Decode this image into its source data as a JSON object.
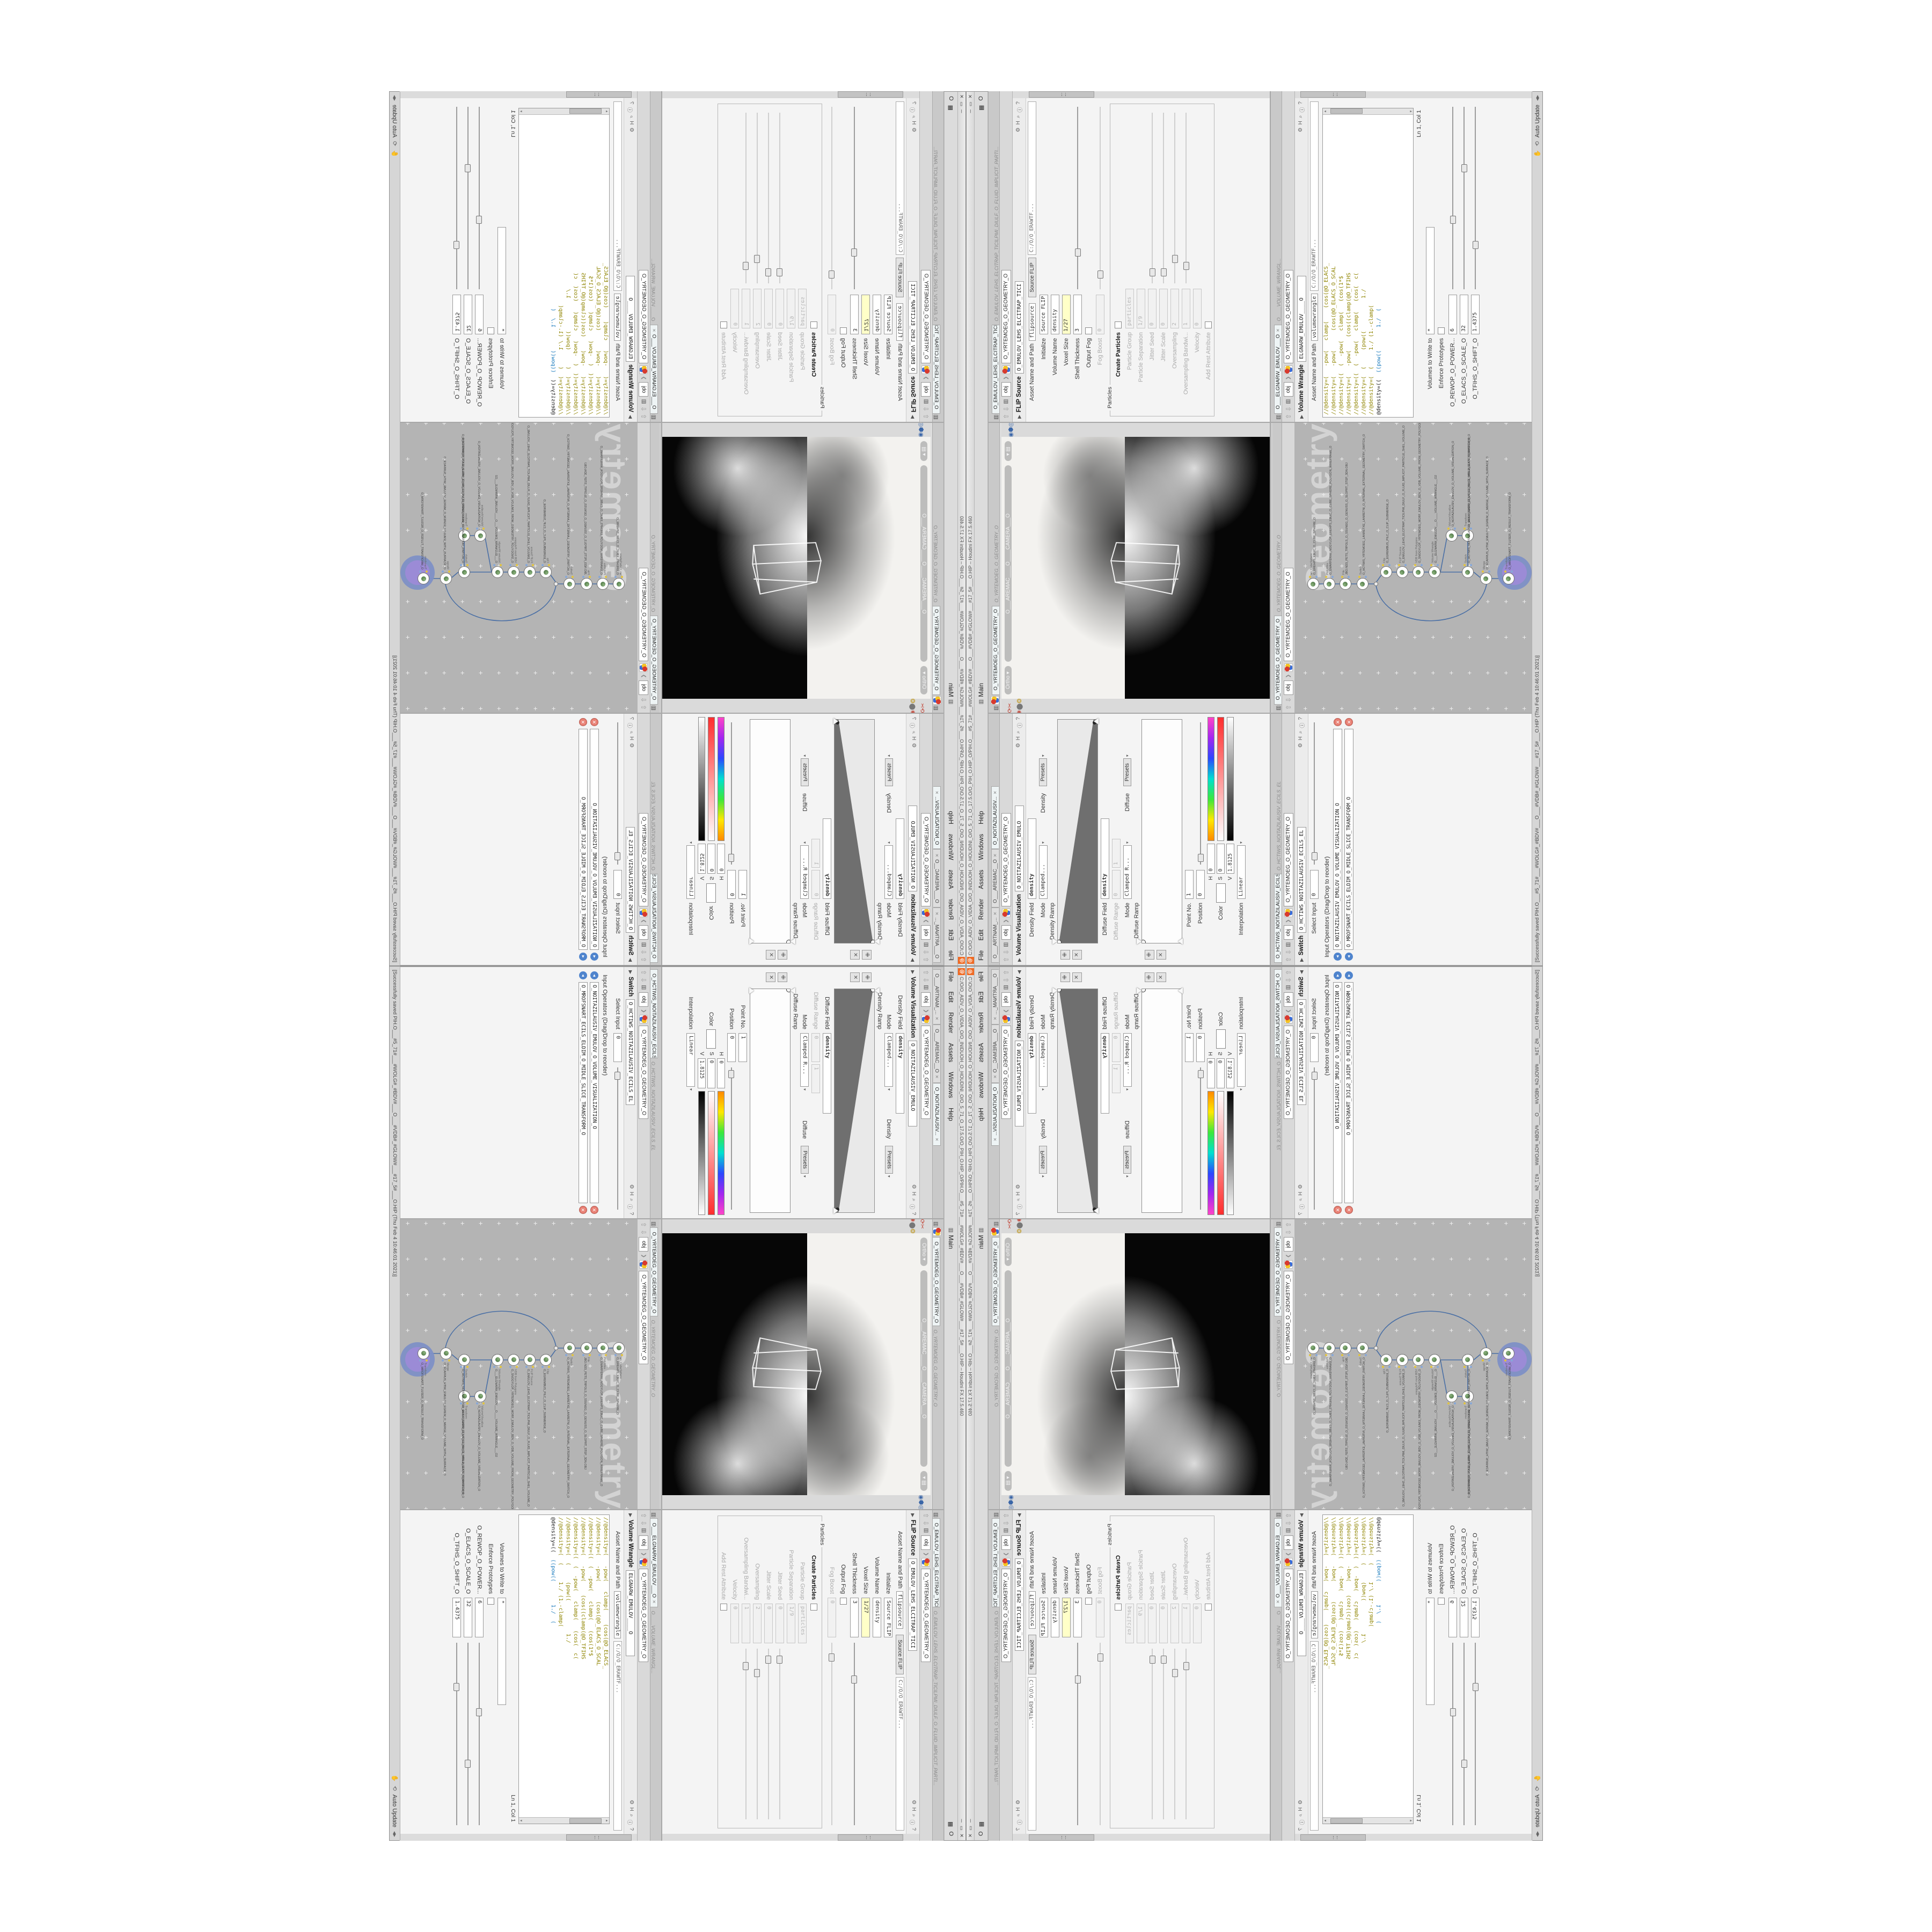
{
  "window": {
    "logo_glyph": "@",
    "title": "C:/O/O_AIDV_O_VIDIA_O/O_INIDUOH_O_HOUDINI_O/O_5_71_O_17.5.O/O_PIH_O.HIP_O/PIH.O___#5_71#___#WOLG#_#BDV#___O___#VDB#_#GLOW#___#17_5#___O.HIP – Houdini FX 17.5.460",
    "btn_min": "─",
    "btn_max": "▭",
    "btn_close": "✕"
  },
  "menu": {
    "items": [
      "File",
      "Edit",
      "Render",
      "Assets",
      "Windows",
      "Help"
    ],
    "desktop_icon": "▥",
    "desktop": "Main",
    "right_grid_icon": "▦",
    "right_o": "O"
  },
  "status": {
    "saved": "[Successfully saved PIH.O___#5_71#___#WOLG#_#BDV#___O___#VDB#_#GLOW#___#17_5#___O.HIP  (Thu Feb  4 10:46:01 2021)]",
    "refresh_icon": "⟲",
    "hand_icon": "✋",
    "auto_update": "Auto Update",
    "dd": "◂▸"
  },
  "crumb": {
    "up": "⇧",
    "down": "⇩",
    "clap": "▥",
    "obj": "obj",
    "sep": "❯",
    "net": "O_YRTEMOEG_O_GEOMETRY_O"
  },
  "flip": {
    "tab": "O_EMULOV_LEHS_ELCITRAP_TICI",
    "title": "O_EMULOV_LEHS_ELCITRAP_TICILPMI_DIULF_O_FLUID_IMPLICIT_PARTI...",
    "type": "FLIP Source",
    "name": "O_EMULOV_LEHS_ELCITRAP_TICI",
    "icons": [
      "⚙",
      "H",
      "⌕",
      "ⓘ",
      "?"
    ],
    "asset_label": "Asset Name and Path",
    "asset": "flipsource",
    "asset_btn": "Source FLIP",
    "path": "C:/O/O_ERAWTF...",
    "params": [
      {
        "l": "Initialize",
        "v": "Source FLIP",
        "cls": "prow"
      },
      {
        "l": "Volume Name",
        "v": "density",
        "cls": "prow"
      },
      {
        "l": "Voxel Size",
        "v": "1/27",
        "cls": "prow hlf"
      },
      {
        "l": "Shell Thickness",
        "v": "3",
        "cls": "prow srow",
        "hs": "left:18%"
      },
      {
        "l": "Output Fog",
        "v": "",
        "cls": "prow cbrow"
      },
      {
        "l": "Fog Boost",
        "v": "0",
        "cls": "prow dis srow",
        "hs": "left:6%"
      }
    ],
    "group": "Particles",
    "pparams": [
      {
        "l": "Create Particles",
        "v": "",
        "cls": "prow cbrow bold"
      },
      {
        "l": "Particle Group",
        "v": "particles",
        "cls": "prow dis"
      },
      {
        "l": "Particle Separation",
        "v": "1/9",
        "cls": "prow dis"
      },
      {
        "l": "Jitter Seed",
        "v": "0",
        "cls": "prow dis srow",
        "hs": "left:4%"
      },
      {
        "l": "Jitter Scale",
        "v": "0",
        "cls": "prow dis srow",
        "hs": "left:4%"
      },
      {
        "l": "Oversampling",
        "v": "2",
        "cls": "prow dis srow",
        "hs": "left:12%"
      },
      {
        "l": "Oversampling Bandwi...",
        "v": "1",
        "cls": "prow dis srow",
        "hs": "left:8%"
      },
      {
        "l": "Velocity",
        "v": "0",
        "cls": "prow dis"
      },
      {
        "l": "Add Rest Attribute",
        "v": "",
        "cls": "prow dis cbrow"
      }
    ]
  },
  "wrangle": {
    "tab": "O___ELGNARW_EMULOV___O",
    "title": "O____VOLUME_WRANGL...",
    "type": "Volume Wrangle",
    "name": "ELGNARW_EMULOV____O",
    "icons": [
      "⚙",
      "H",
      "⌕",
      "ⓘ",
      "?"
    ],
    "asset_label": "Asset Name and Path",
    "asset": "volumewrangle",
    "path": "C:/O/O_ERAWTF...",
    "code": [
      {
        "t": "//@density=(   -pow(   clamp(    (cos(@O_ELACS_"
      },
      {
        "t": "//@density=(   -pow(      (cos(@O_ELACS_O_SCAL"
      },
      {
        "t": "//@density=((  (  -pow(   clamp(   (cos(1*$"
      },
      {
        "t": "//@density=(   -pow(    (cos((clamp(@O_TFIHS"
      },
      {
        "t": "//@density=((  (  -pow(   clamp(   (cos(  c("
      },
      {
        "t": "//@density=(  (     (pow((          1./"
      },
      {
        "t": "//@density=(  (     1./ (1.-clamp("
      }
    ],
    "code_active": "@density=((  ",
    "code_active_blue": "((pow((       1./  (",
    "up_tri": "▴",
    "dn_tri": "▾",
    "lncol": "Ln 1, Col 1",
    "vol_label": "Volumes to Write to",
    "vol": "*",
    "enforce": "Enforce Prototypes",
    "sliders": [
      {
        "l": "O_REWOP_O_POWER...",
        "v": "6",
        "hs": "left:36%"
      },
      {
        "l": "O_ELACS_O_SCALE_O",
        "v": "32",
        "hs": "left:64%"
      },
      {
        "l": "O_TFIHS_O_SHIFT_O",
        "v": "1.4375",
        "hs": "left:22%"
      }
    ]
  },
  "viewport": {
    "tab": "O_YRTEMOEG_O_GEOMETRY_O",
    "top_icons": [
      {
        "g": "◂",
        "n": "back-arrow-icon",
        "c": "vicon"
      },
      {
        "g": "⌕",
        "n": "select-tool-icon",
        "c": "vicon"
      },
      {
        "g": "✎",
        "n": "edit-tool-icon",
        "c": "vicon"
      },
      {
        "g": "✣",
        "n": "handles-tool-icon",
        "c": "vicon"
      },
      {
        "g": "◧",
        "n": "box-tool-icon",
        "c": "vicon"
      },
      {
        "g": "▦",
        "n": "uv-grid-icon",
        "c": "vicon"
      },
      {
        "g": "Y",
        "n": "wire-tool-icon",
        "c": "vicon"
      },
      {
        "g": "▣",
        "n": "snapshot-icon",
        "c": "vicon"
      },
      {
        "g": "◎",
        "n": "orbit-view-icon",
        "c": "vicon"
      },
      {
        "g": "⧉",
        "n": "quad-layout-icon",
        "c": "vicon hl"
      },
      {
        "g": "◔",
        "n": "shaded-view-icon",
        "c": "vicon"
      }
    ],
    "left_icons": [
      {
        "g": "➤",
        "n": "cursor-icon",
        "c": "tico"
      },
      {
        "g": "✥",
        "n": "move-tool-icon",
        "c": "tico red"
      },
      {
        "g": "⟳",
        "n": "rotate-tool-icon",
        "c": "tico red"
      },
      {
        "g": "✂",
        "n": "cut-tool-icon",
        "c": "tico red"
      },
      {
        "g": "⌗",
        "n": "snap-grid-icon",
        "c": "tico"
      },
      {
        "g": "◆",
        "n": "key-icon",
        "c": "tico blu"
      },
      {
        "g": "✺",
        "n": "render-icon",
        "c": "tico red"
      },
      {
        "g": "⬤",
        "n": "flipbook-icon",
        "c": "tico"
      },
      {
        "g": "❂",
        "n": "lights-icon",
        "c": "tico yel"
      },
      {
        "g": "▩",
        "n": "objects-icon",
        "c": "tico"
      },
      {
        "g": "∞",
        "n": "loop-icon",
        "c": "tico blu"
      }
    ],
    "right_icons": [
      {
        "g": "▢",
        "n": "view-rect-icon",
        "c": "tico"
      },
      {
        "g": "◉",
        "n": "camera-view-icon",
        "c": "tico blu"
      },
      {
        "g": "⬢",
        "n": "geometry-view-icon",
        "c": "tico blu"
      },
      {
        "g": "◎",
        "n": "target-rings-icon",
        "c": "tico blu"
      },
      {
        "g": "❂",
        "n": "pin-icon",
        "c": "tico"
      }
    ],
    "ortho": "Ortho ▾",
    "camera": "O___AREMAC____O____CAMERA___O",
    "cam_lock": "▾ ▤",
    "wire_d": "M218,212 L258,204 L252,332 L196,318 Z M258,204 L292,214 L287,330 L252,332 M218,212 L224,330 M196,318 L287,330"
  },
  "network": {
    "tab": "O_YRTEMOEG_O_GEOMETRY_O",
    "title": "O_YRTEMOEG_O_GEOMETRY_O",
    "watermark": "Geometry",
    "wire_d": "M240,45 V115 M240,137 V148 M244,152 L258,162 M262,181 V189 M262,211 V219 M262,241 V249 M262,271 L326,283 M330,303 V311 M262,271 V311 M319,322 L273,322 M262,333 L252,345 M250,367 V387 M237,151 C148,168 150,338 239,357",
    "nodes": [
      {
        "t": "an_CubeSphere",
        "n": "O_EREHPS_EBUC_O_CUBE_SPHERE_O",
        "pos": "left:229px;top:23px"
      },
      {
        "t": "PolyWire",
        "n": "O_EMARFERIW_NOGYLOP_EREHPS_EBUC_O_CUBE_SPHERE_POLYGON_WIREFRAME_O",
        "pos": "left:229px;top:53px"
      },
      {
        "t": "File",
        "n": "JBO.ND3_PETS_TRPOLS_O_SSUNEG_O_GENUSS_O_SLOPRT_STEP_3DN.OBJ",
        "pos": "left:229px;top:83px"
      },
      {
        "t": "Switch",
        "n": "O_HCTIWS_YRTEMOEG_LANRETXE_LANRETNI_O_INTERNAL_EXTERNAL_GEOMETRY_SWITCH_O",
        "pos": "left:229px;top:115px"
      },
      {
        "t": "Clip",
        "n": "O_EGREMBUS_PILC_O_CLIP_SUBMERGE_O",
        "pos": "left:251px;top:159px"
      },
      {
        "t": "FLIP Source",
        "n": "O_EMULOV_LEHS_ELCITRAP_TICILPMI_DIULF_O_FLUID_IMPLICIT_PARTICLE_SHEL_VOLUME_O",
        "pos": "left:251px;top:189px"
      },
      {
        "t": "VDB from Polygons",
        "n": "O_SNOGYLOP_YRTEMOEG_MORF_EMULOV_BDV_O_VDB_VOLUME_FROM_GEOMETRY_POLYGONS_O",
        "pos": "left:251px;top:219px"
      },
      {
        "t": "Volume Wrangle",
        "n": "O___ELGNARW_EMULOV___O____VOLUME_WRANGLE___O2",
        "pos": "left:251px;top:249px"
      },
      {
        "t": "VolumeVisualiza",
        "n": "O_NOITAZILAUSIV_EMULOV_O_VOLUME_VISUALIZATION_O",
        "pos": "left:319px;top:281px"
      },
      {
        "t": "Transform",
        "n": "O_MROFSNART_ECILS_ELDIM_O_MIDLE_SLICE_TRANSFORM_O",
        "pos": "left:319px;top:311px"
      },
      {
        "t": "Switch",
        "n": "O_HCTIWS_NOITAZILAUSIV_ECILS_ELDIM_O_MIDLE_SLICE_VISUALIZATION_SWITCH_O",
        "pos": "left:251px;top:311px"
      },
      {
        "t": "Merge",
        "n": "O_ECAFRUS_HTIW_EMULOV_EGREM_O_MERGE_VOLUME_WITH_SURFACE_O",
        "pos": "left:239px;top:345px"
      },
      {
        "t": "Transform",
        "n": "O_MROFSNART_TLUSER_O_RESULT_TRANSFORM_O",
        "pos": "left:239px;top:387px",
        "sel": "1"
      }
    ],
    "halo_pos": "left:229px;top:377px"
  },
  "volvis": {
    "tabs": [
      {
        "label": "O___ARTNAM_...",
        "cls": "ptab"
      },
      {
        "label": "O___AREMAC__O",
        "cls": "ptab"
      },
      {
        "label": "O_NOITAZILAUSIV...",
        "cls": "ptab act"
      }
    ],
    "type": "Volume Visualization",
    "name": "O_NOITAZILAUSIV_EMULO",
    "icons": [
      "⚙",
      "H",
      "⌕",
      "ⓘ",
      "?"
    ],
    "density_field_label": "Density Field",
    "density_field": "density",
    "mode_label": "Mode",
    "mode": "Clamped...",
    "density_group": "Density",
    "presets": "Presets",
    "density_ramp_label": "Density Ramp",
    "plus": "✙",
    "del": "✕",
    "diffuse_field_label": "Diffuse Field",
    "diffuse_field": "density",
    "diffuse_range_label": "Diffuse Range",
    "dr0": "0",
    "dr1": "1",
    "mode2_label": "Mode",
    "mode2": "Clamped R...",
    "diffuse_group": "Diffuse",
    "diffuse_ramp_label": "Diffuse Ramp",
    "point_label": "Point No.",
    "point": "1",
    "position_label": "Position",
    "position": "0",
    "color_label": "Color",
    "h_label": "H",
    "h": "0",
    "s_label": "S",
    "s": "0",
    "v_label": "V",
    "v": "1.8125",
    "interp_label": "Interpolation",
    "interp": "Linear"
  },
  "switch": {
    "tab": "O_HCTIWS_NOITAZILAUSIV_ECILS_EL",
    "type": "Switch",
    "name": "O_HCTIWS_NOITAZILAUSIV_ECILS_EL",
    "icons": [
      "⚙",
      "H",
      "⌕",
      "ⓘ",
      "?"
    ],
    "select_label": "Select Input",
    "select": "0",
    "select_hs": "left:3%",
    "oplist_label": "Input Operators (Drag/Drop to reorder)",
    "inputs": [
      {
        "v": "O_NOITAZILAUSIV_EMULOV_O_VOLUME_VISUALIZATION_O"
      },
      {
        "v": "O_MROFSNART_ECILS_ELDIM_O_MIDLE_SLICE_TRANSFORM_O"
      }
    ],
    "arrow": "◂",
    "x": "✕"
  }
}
